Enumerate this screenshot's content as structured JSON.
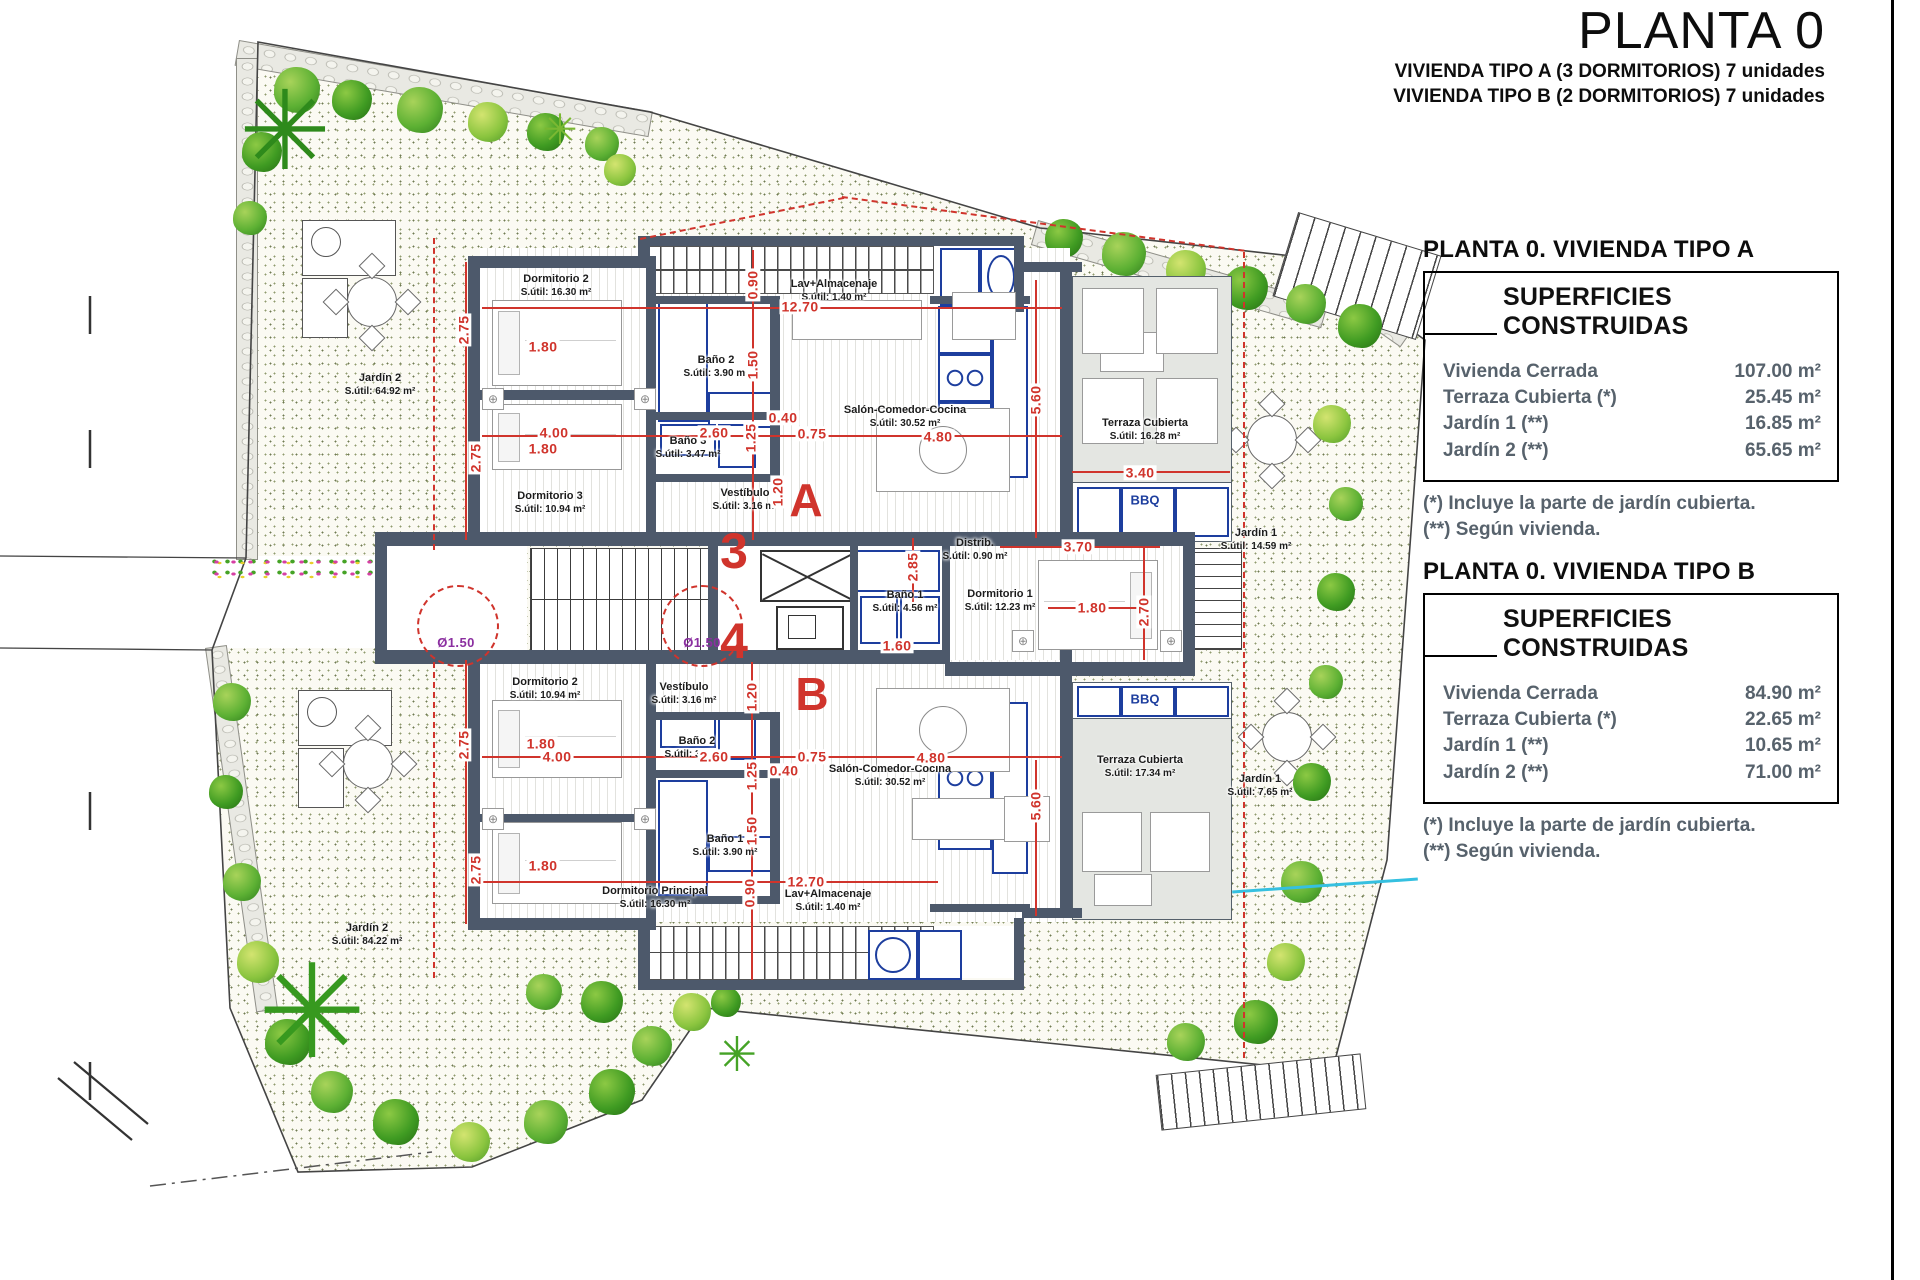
{
  "header": {
    "title": "PLANTA 0",
    "subtitle_line1": "VIVIENDA TIPO A (3 DORMITORIOS) 7 unidades",
    "subtitle_line2": "VIVIENDA TIPO B (2 DORMITORIOS) 7 unidades"
  },
  "panels": [
    {
      "header": "PLANTA 0. VIVIENDA TIPO A",
      "box_title": "SUPERFICIES CONSTRUIDAS",
      "rows": [
        {
          "label": "Vivienda Cerrada",
          "value": "107.00 m²"
        },
        {
          "label": "Terraza Cubierta  (*)",
          "value": "25.45 m²"
        },
        {
          "label": "Jardín 1 (**)",
          "value": "16.85 m²"
        },
        {
          "label": "Jardín 2 (**)",
          "value": "65.65 m²"
        }
      ],
      "notes": [
        "(*)  Incluye la parte de jardín cubierta.",
        "(**) Según vivienda."
      ]
    },
    {
      "header": "PLANTA 0. VIVIENDA TIPO B",
      "box_title": "SUPERFICIES CONSTRUIDAS",
      "rows": [
        {
          "label": "Vivienda Cerrada",
          "value": "84.90 m²"
        },
        {
          "label": "Terraza Cubierta (*)",
          "value": "22.65 m²"
        },
        {
          "label": "Jardín 1 (**)",
          "value": "10.65 m²"
        },
        {
          "label": "Jardín 2 (**)",
          "value": "71.00 m²"
        }
      ],
      "notes": [
        "(*) Incluye la parte de jardín cubierta.",
        "(**) Según vivienda."
      ]
    }
  ],
  "plan": {
    "markers": {
      "unit_a": "A",
      "unit_b": "B",
      "stair_core_upper": "3",
      "stair_core_lower": "4",
      "bbq": "BBQ"
    },
    "rooms": {
      "dorm2_a": {
        "name": "Dormitorio 2",
        "area": "S.útil: 16.30 m²"
      },
      "lav_a": {
        "name": "Lav+Almacenaje",
        "area": "S.útil: 1.40 m²"
      },
      "salon_a": {
        "name": "Salón-Comedor-Cocina",
        "area": "S.útil: 30.52 m²"
      },
      "bano2_a": {
        "name": "Baño 2",
        "area": "S.útil: 3.90 m²"
      },
      "bano3_a": {
        "name": "Baño 3",
        "area": "S.útil: 3.47 m²"
      },
      "dorm3_a": {
        "name": "Dormitorio 3",
        "area": "S.útil: 10.94 m²"
      },
      "vest_a": {
        "name": "Vestíbulo",
        "area": "S.útil: 3.16 m²"
      },
      "terraza_a": {
        "name": "Terraza Cubierta",
        "area": "S.útil: 16.28 m²"
      },
      "jardin1_a": {
        "name": "Jardín 1",
        "area": "S.útil: 14.59 m²"
      },
      "jardin2_a": {
        "name": "Jardín 2",
        "area": "S.útil: 64.92 m²"
      },
      "distrib": {
        "name": "Distrib.",
        "area": "S.útil: 0.90 m²"
      },
      "bano1_core": {
        "name": "Baño 1",
        "area": "S.útil: 4.56 m²"
      },
      "dorm1_a": {
        "name": "Dormitorio 1",
        "area": "S.útil: 12.23 m²"
      },
      "vest_b": {
        "name": "Vestíbulo",
        "area": "S.útil: 3.16 m²"
      },
      "dorm2_b": {
        "name": "Dormitorio 2",
        "area": "S.útil: 10.94 m²"
      },
      "bano2_b": {
        "name": "Baño 2",
        "area": "S.útil: 3.47 m²"
      },
      "bano1_b": {
        "name": "Baño 1",
        "area": "S.útil: 3.90 m²"
      },
      "dormP_b": {
        "name": "Dormitorio Principal",
        "area": "S.útil: 16.30 m²"
      },
      "lav_b": {
        "name": "Lav+Almacenaje",
        "area": "S.útil: 1.40 m²"
      },
      "salon_b": {
        "name": "Salón-Comedor-Cocina",
        "area": "S.útil: 30.52 m²"
      },
      "terraza_b": {
        "name": "Terraza Cubierta",
        "area": "S.útil: 17.34 m²"
      },
      "jardin1_b": {
        "name": "Jardín 1",
        "area": "S.útil: 7.65 m²"
      },
      "jardin2_b": {
        "name": "Jardín 2",
        "area": "S.útil: 84.22 m²"
      }
    },
    "dims": [
      {
        "t": "12.70",
        "x": 800,
        "y": 307
      },
      {
        "t": "0.90",
        "x": 753,
        "y": 285,
        "v": 1
      },
      {
        "t": "1.80",
        "x": 543,
        "y": 347
      },
      {
        "t": "2.75",
        "x": 464,
        "y": 330,
        "v": 1
      },
      {
        "t": "4.00",
        "x": 554,
        "y": 433
      },
      {
        "t": "1.80",
        "x": 543,
        "y": 449
      },
      {
        "t": "2.60",
        "x": 714,
        "y": 433
      },
      {
        "t": "1.25",
        "x": 751,
        "y": 438,
        "v": 1
      },
      {
        "t": "0.40",
        "x": 783,
        "y": 418
      },
      {
        "t": "0.75",
        "x": 812,
        "y": 434
      },
      {
        "t": "1.50",
        "x": 753,
        "y": 365,
        "v": 1
      },
      {
        "t": "2.75",
        "x": 476,
        "y": 458,
        "v": 1
      },
      {
        "t": "4.80",
        "x": 938,
        "y": 437
      },
      {
        "t": "5.60",
        "x": 1036,
        "y": 400,
        "v": 1
      },
      {
        "t": "3.40",
        "x": 1140,
        "y": 473
      },
      {
        "t": "1.20",
        "x": 778,
        "y": 492,
        "v": 1
      },
      {
        "t": "2.85",
        "x": 913,
        "y": 567,
        "v": 1
      },
      {
        "t": "1.60",
        "x": 897,
        "y": 646
      },
      {
        "t": "3.70",
        "x": 1078,
        "y": 547
      },
      {
        "t": "1.80",
        "x": 1092,
        "y": 608
      },
      {
        "t": "2.70",
        "x": 1144,
        "y": 612,
        "v": 1
      },
      {
        "t": "1.20",
        "x": 752,
        "y": 697,
        "v": 1
      },
      {
        "t": "2.60",
        "x": 714,
        "y": 757
      },
      {
        "t": "4.00",
        "x": 557,
        "y": 757
      },
      {
        "t": "1.80",
        "x": 541,
        "y": 744
      },
      {
        "t": "2.75",
        "x": 464,
        "y": 745,
        "v": 1
      },
      {
        "t": "0.75",
        "x": 812,
        "y": 757
      },
      {
        "t": "0.40",
        "x": 784,
        "y": 771
      },
      {
        "t": "1.25",
        "x": 752,
        "y": 776,
        "v": 1
      },
      {
        "t": "1.50",
        "x": 752,
        "y": 831,
        "v": 1
      },
      {
        "t": "1.80",
        "x": 543,
        "y": 866
      },
      {
        "t": "2.75",
        "x": 476,
        "y": 870,
        "v": 1
      },
      {
        "t": "12.70",
        "x": 806,
        "y": 882
      },
      {
        "t": "0.90",
        "x": 750,
        "y": 893,
        "v": 1
      },
      {
        "t": "4.80",
        "x": 931,
        "y": 758
      },
      {
        "t": "5.60",
        "x": 1036,
        "y": 806,
        "v": 1
      }
    ],
    "diameters": [
      {
        "t": "Ø1.50",
        "x": 456,
        "y": 643
      },
      {
        "t": "Ø1.50",
        "x": 702,
        "y": 643
      }
    ]
  }
}
